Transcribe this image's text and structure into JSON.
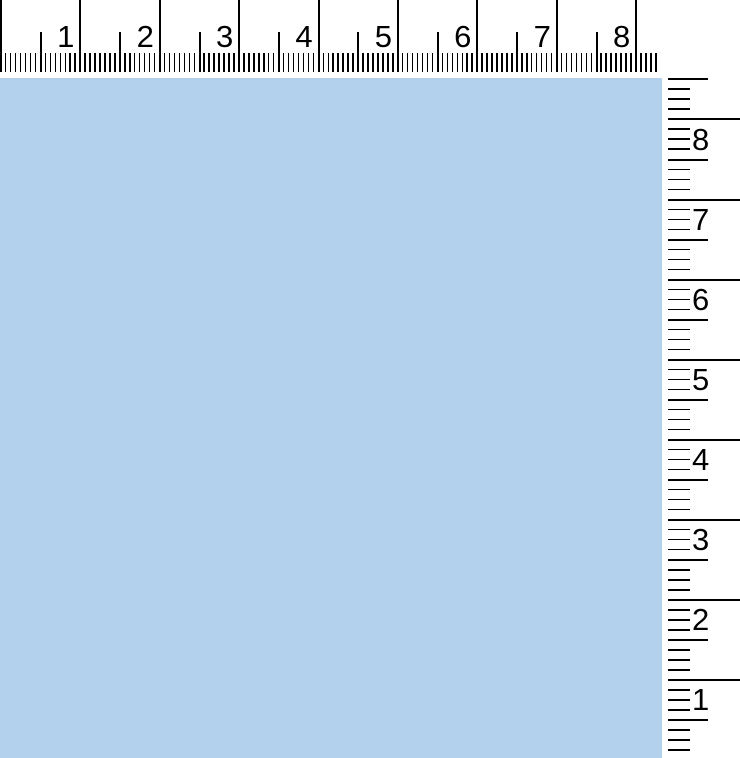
{
  "canvas": {
    "fill_color": "#b3d0ed"
  },
  "rulers": {
    "horizontal": {
      "position": "top",
      "labels": [
        "1",
        "2",
        "3",
        "4",
        "5",
        "6",
        "7",
        "8"
      ],
      "px_per_unit": 79.4,
      "subdivisions_per_unit": 16,
      "length_px": 661
    },
    "vertical": {
      "position": "right",
      "labels": [
        "8",
        "7",
        "6",
        "5",
        "4",
        "3",
        "2",
        "1"
      ],
      "px_per_unit": 80.1,
      "subdivisions_per_unit": 8,
      "first_tick_y_px": 78.4,
      "whole_tick_index_offset": 4,
      "max_y_px": 755
    }
  },
  "colors": {
    "tick": "#000000",
    "ruler_background": "#ffffff",
    "canvas_fill": "#b3d0ed"
  }
}
